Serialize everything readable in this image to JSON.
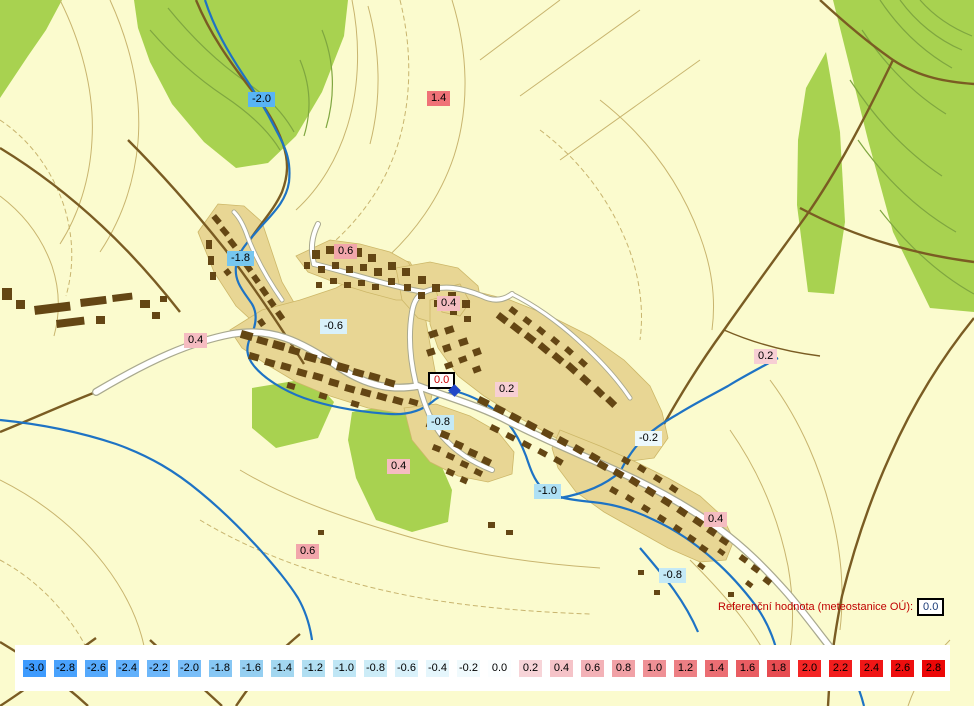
{
  "map": {
    "background_color": "#FBFBCE",
    "reference_label": "Referenční hodnota (meteostanice OÚ):",
    "reference_value": "0.0",
    "station": {
      "value": "0.0",
      "x": 428,
      "y": 372,
      "text_color": "#CC0000",
      "marker_color": "#2247C8",
      "marker_x": 450,
      "marker_y": 386
    },
    "labels": [
      {
        "value": "-2.0",
        "x": 248,
        "y": 92,
        "color": "#58B4F4"
      },
      {
        "value": "1.4",
        "x": 427,
        "y": 91,
        "color": "#EF7277"
      },
      {
        "value": "0.6",
        "x": 334,
        "y": 244,
        "color": "#F2A6AB"
      },
      {
        "value": "-1.8",
        "x": 227,
        "y": 251,
        "color": "#76C6EF"
      },
      {
        "value": "0.4",
        "x": 437,
        "y": 296,
        "color": "#F5BCC1"
      },
      {
        "value": "-0.6",
        "x": 320,
        "y": 319,
        "color": "#D9F1FA"
      },
      {
        "value": "0.4",
        "x": 184,
        "y": 333,
        "color": "#F5BCC1"
      },
      {
        "value": "0.2",
        "x": 495,
        "y": 382,
        "color": "#F7CFD4"
      },
      {
        "value": "-0.8",
        "x": 427,
        "y": 415,
        "color": "#C4E9F6"
      },
      {
        "value": "0.2",
        "x": 754,
        "y": 349,
        "color": "#F7CFD4"
      },
      {
        "value": "-0.2",
        "x": 635,
        "y": 431,
        "color": "#ECF8FC"
      },
      {
        "value": "0.4",
        "x": 387,
        "y": 459,
        "color": "#F5BCC1"
      },
      {
        "value": "-1.0",
        "x": 534,
        "y": 484,
        "color": "#AEE0F4"
      },
      {
        "value": "0.4",
        "x": 704,
        "y": 512,
        "color": "#F5BCC1"
      },
      {
        "value": "0.6",
        "x": 296,
        "y": 544,
        "color": "#F2A6AB"
      },
      {
        "value": "-0.8",
        "x": 659,
        "y": 568,
        "color": "#C4E9F6"
      }
    ]
  },
  "legend": {
    "entries": [
      {
        "value": "-3.0",
        "color": "#3E9BFE"
      },
      {
        "value": "-2.8",
        "color": "#49A2FD"
      },
      {
        "value": "-2.6",
        "color": "#55A9FC"
      },
      {
        "value": "-2.4",
        "color": "#61B0FB"
      },
      {
        "value": "-2.2",
        "color": "#6DB7FA"
      },
      {
        "value": "-2.0",
        "color": "#79BEF8"
      },
      {
        "value": "-1.8",
        "color": "#87C7F4"
      },
      {
        "value": "-1.6",
        "color": "#95CFF1"
      },
      {
        "value": "-1.4",
        "color": "#A3D7F0"
      },
      {
        "value": "-1.2",
        "color": "#B1DFF2"
      },
      {
        "value": "-1.0",
        "color": "#BFE6F5"
      },
      {
        "value": "-0.8",
        "color": "#CCECF7"
      },
      {
        "value": "-0.6",
        "color": "#D9F1FA"
      },
      {
        "value": "-0.4",
        "color": "#E5F6FC"
      },
      {
        "value": "-0.2",
        "color": "#F0FAFD"
      },
      {
        "value": "0.0",
        "color": "#FBFEFF"
      },
      {
        "value": "0.2",
        "color": "#F7D4D8"
      },
      {
        "value": "0.4",
        "color": "#F5C3C8"
      },
      {
        "value": "0.6",
        "color": "#F3B2B7"
      },
      {
        "value": "0.8",
        "color": "#F1A1A6"
      },
      {
        "value": "1.0",
        "color": "#EF9095"
      },
      {
        "value": "1.2",
        "color": "#ED7F84"
      },
      {
        "value": "1.4",
        "color": "#EB6E73"
      },
      {
        "value": "1.6",
        "color": "#E95D62"
      },
      {
        "value": "1.8",
        "color": "#E74C51"
      },
      {
        "value": "2.0",
        "color": "#F42525"
      },
      {
        "value": "2.2",
        "color": "#F21D1D"
      },
      {
        "value": "2.4",
        "color": "#F01616"
      },
      {
        "value": "2.6",
        "color": "#EE0E0E"
      },
      {
        "value": "2.8",
        "color": "#EC0707"
      }
    ]
  }
}
